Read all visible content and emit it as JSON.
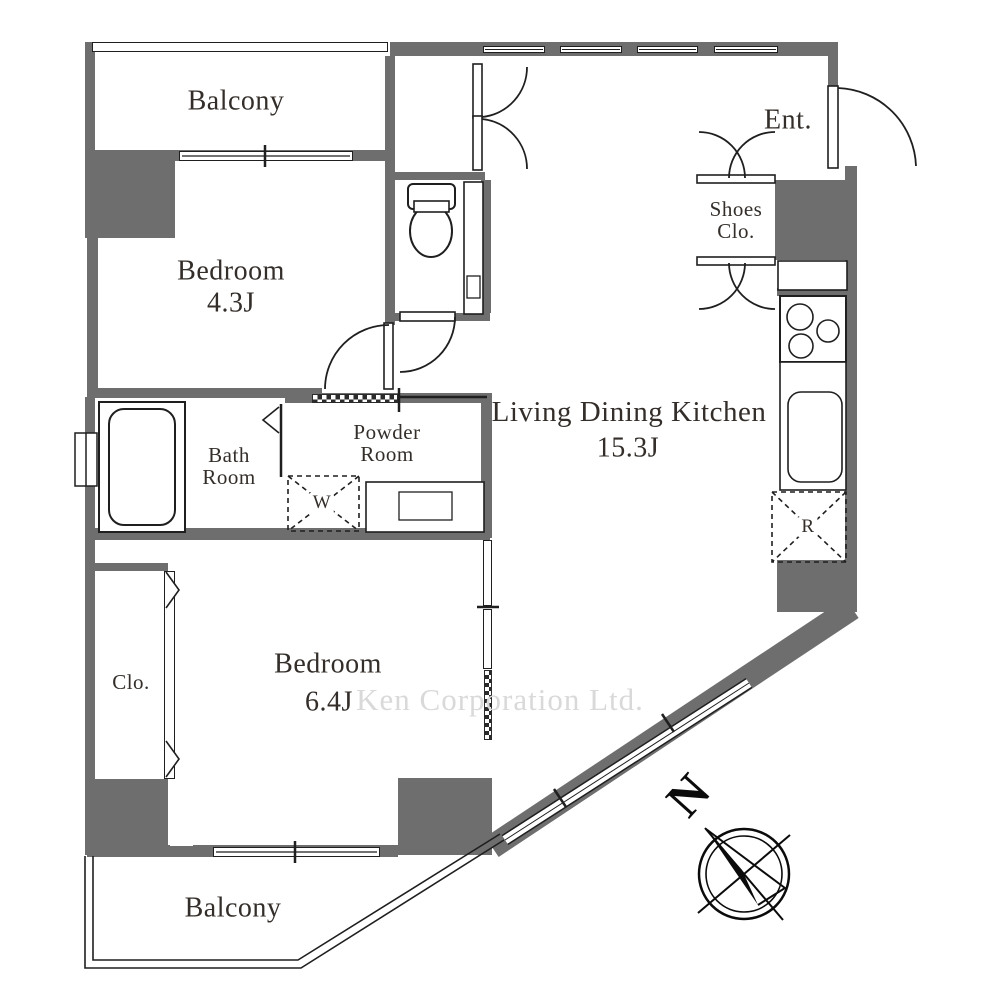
{
  "plan": {
    "labels": {
      "balcony_top": "Balcony",
      "bedroom1_name": "Bedroom",
      "bedroom1_size": "4.3J",
      "entrance": "Ent.",
      "shoes_line1": "Shoes",
      "shoes_line2": "Clo.",
      "ldk_name": "Living Dining Kitchen",
      "ldk_size": "15.3J",
      "bath_line1": "Bath",
      "bath_line2": "Room",
      "powder_line1": "Powder",
      "powder_line2": "Room",
      "washer": "W",
      "fridge": "R",
      "closet": "Clo.",
      "bedroom2_name": "Bedroom",
      "bedroom2_size": "6.4J",
      "balcony_bottom": "Balcony",
      "compass_north": "N",
      "watermark": "Ken Corporation Ltd."
    },
    "colors": {
      "wall": "#6e6e6e",
      "outline": "#1f1f1f",
      "text": "#332e2a",
      "watermark": "#d9d9d9"
    }
  }
}
